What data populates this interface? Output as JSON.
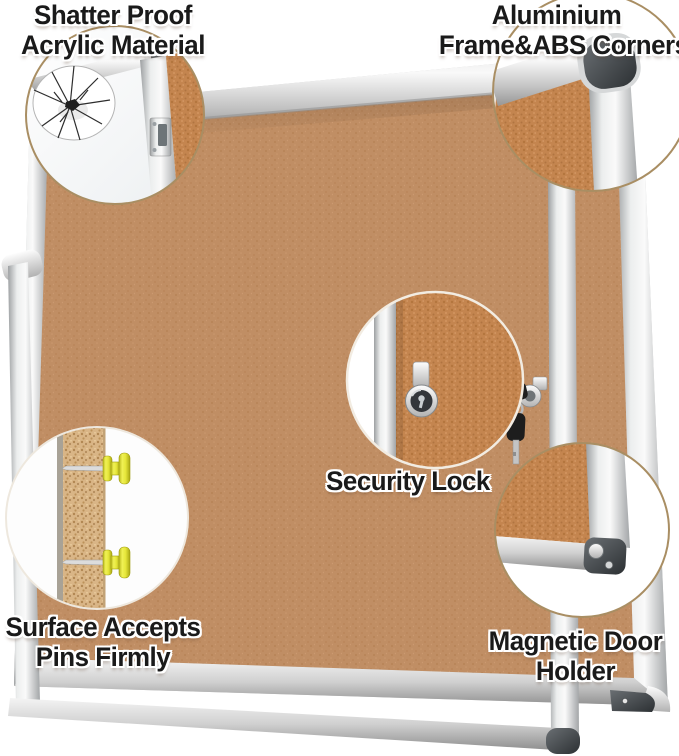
{
  "labels": {
    "shatter_proof": {
      "line1": "Shatter Proof",
      "line2": "Acrylic Material"
    },
    "aluminium_frame": {
      "line1": "Aluminium",
      "line2": "Frame&ABS Corners"
    },
    "security_lock": {
      "line1": "Security Lock"
    },
    "pins": {
      "line1": "Surface Accepts",
      "line2": "Pins Firmly"
    },
    "magnetic_holder": {
      "line1": "Magnetic Door",
      "line2": "Holder"
    }
  },
  "colors": {
    "background": "#ffffff",
    "cork": "#c08e64",
    "cork_magnified": "#c4854f",
    "cork_cross_section": "#d9b586",
    "frame_silver": "#d9d9d9",
    "abs_corner_dark": "#3e4346",
    "pin_yellow": "#e3e13f",
    "label_text": "#1a1a1a",
    "label_outline": "#ffffff",
    "callout_ring": "#aa8d61"
  }
}
